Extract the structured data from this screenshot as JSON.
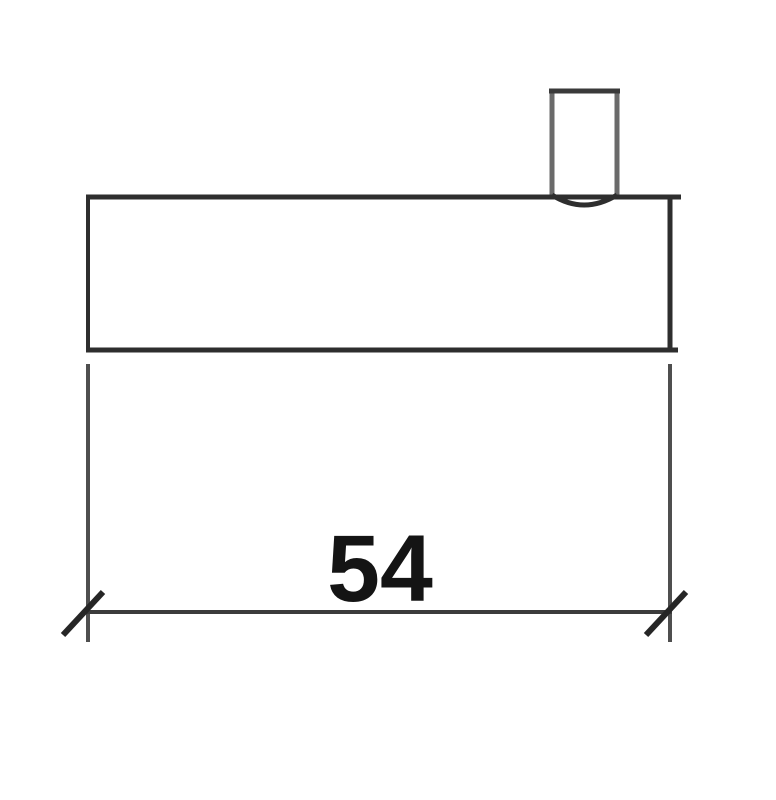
{
  "drawing": {
    "dimension": {
      "value_label": "54"
    },
    "colors": {
      "background": "#ffffff",
      "outline": "#2e2e2e",
      "boss_side": "#6a6a6a",
      "boss_top": "#3a3a3a",
      "extension_line": "#4f4f4f",
      "dimension_line": "#3c3c3c",
      "tick": "#262626",
      "text": "#141414"
    }
  }
}
